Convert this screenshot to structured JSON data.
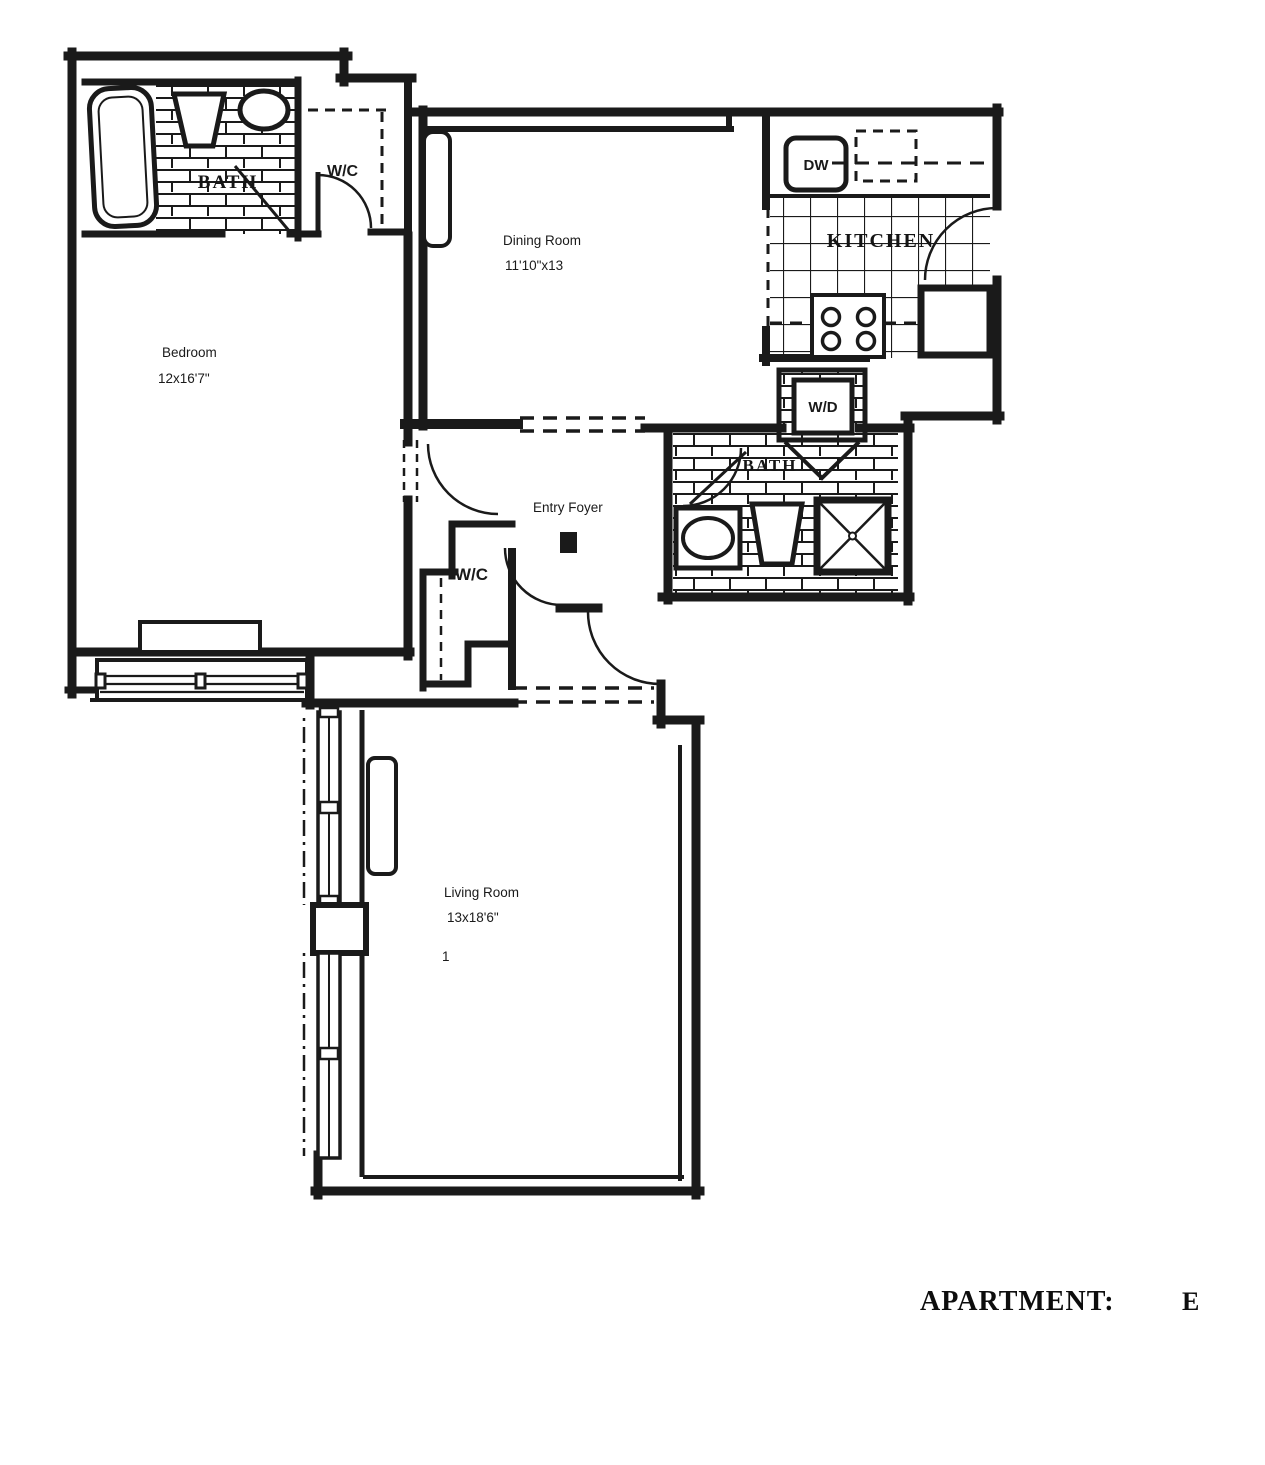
{
  "title": "Apartment floor plan",
  "rooms": {
    "bedroom": {
      "name": "Bedroom",
      "dims": "12x16'7\""
    },
    "dining_room": {
      "name": "Dining Room",
      "dims": "11'10\"x13"
    },
    "living_room": {
      "name": "Living Room",
      "dims": "13x18'6\"",
      "mark": "1"
    },
    "entry_foyer": {
      "name": "Entry Foyer"
    },
    "kitchen": {
      "name": "KITCHEN"
    },
    "bath_upper": {
      "name": "BATH"
    },
    "bath_lower": {
      "name": "BATH"
    },
    "wc_upper": {
      "name": "W/C"
    },
    "wc_foyer": {
      "name": "W/C"
    }
  },
  "appliances": {
    "dishwasher": "DW",
    "washer_dryer": "W/D"
  },
  "footer": {
    "label": "APARTMENT:",
    "unit": "E"
  },
  "colors": {
    "ink": "#1a1a1a",
    "paper": "#ffffff"
  }
}
